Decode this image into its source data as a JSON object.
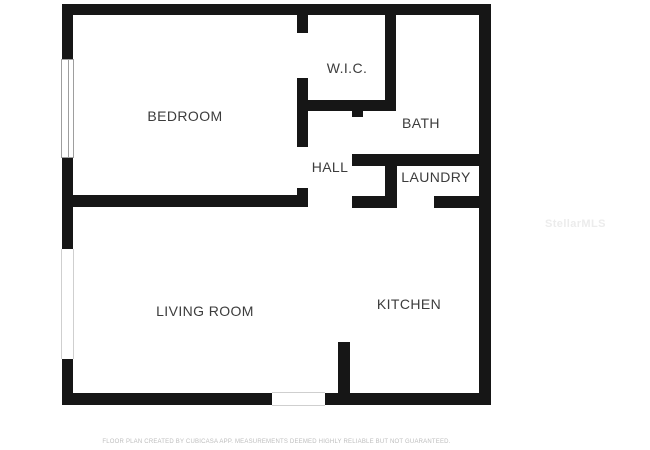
{
  "rooms": {
    "bedroom": {
      "label": "BEDROOM"
    },
    "wic": {
      "label": "W.I.C."
    },
    "bath": {
      "label": "BATH"
    },
    "hall": {
      "label": "HALL"
    },
    "laundry": {
      "label": "LAUNDRY"
    },
    "living_room": {
      "label": "LIVING ROOM"
    },
    "kitchen": {
      "label": "KITCHEN"
    }
  },
  "watermark": {
    "text": "StellarMLS"
  },
  "footer": {
    "disclaimer": "FLOOR PLAN CREATED BY CUBICASA APP. MEASUREMENTS DEEMED HIGHLY RELIABLE BUT NOT GUARANTEED."
  },
  "colors": {
    "wall": "#161616",
    "background": "#ffffff",
    "label_text": "#3c3c3c",
    "window_frame": "#9e9e9e",
    "footer_text": "#bdbdbd",
    "watermark_text": "#ececec"
  }
}
